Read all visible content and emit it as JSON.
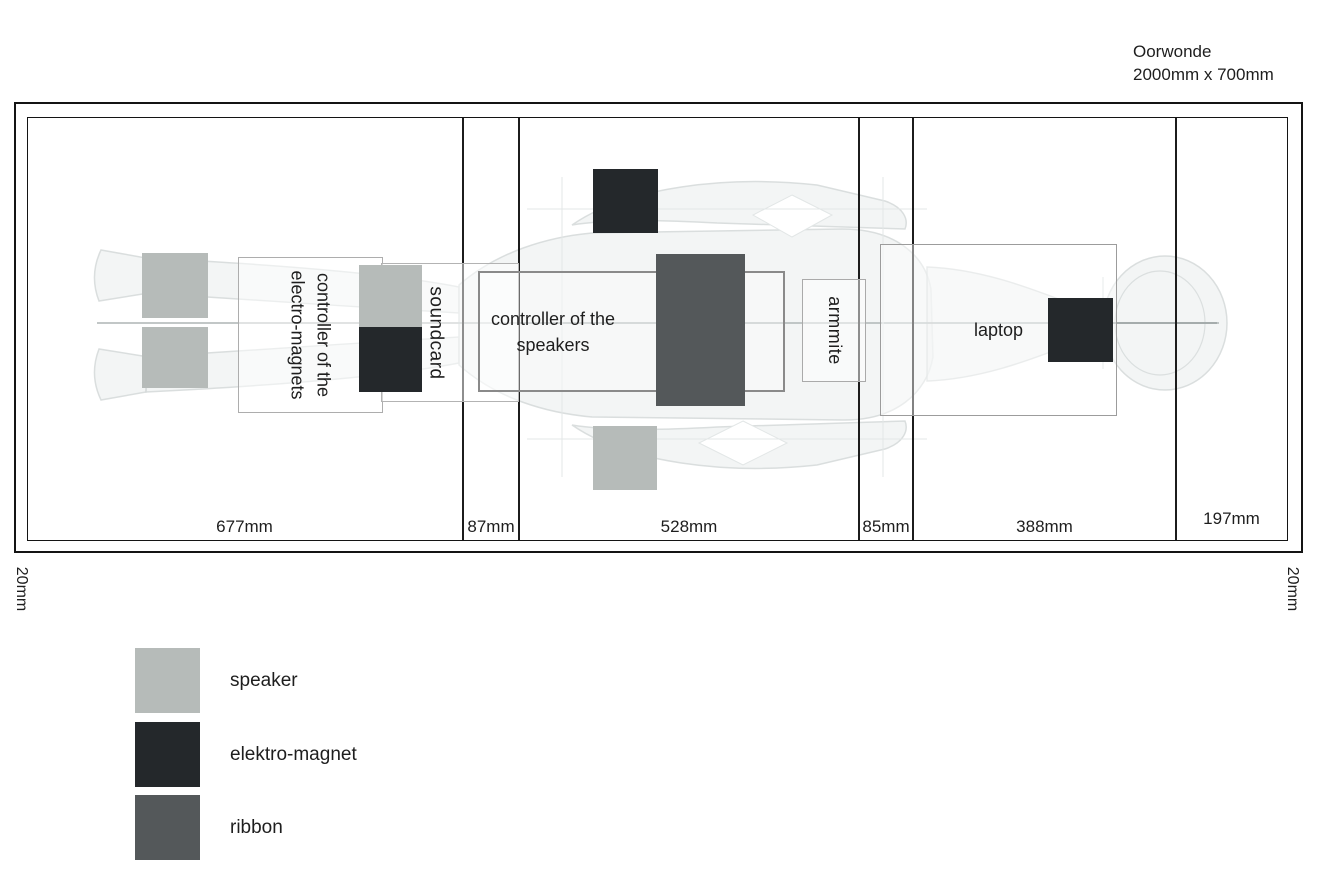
{
  "title": {
    "line1": "Oorwonde",
    "line2": "2000mm x 700mm"
  },
  "frame": {
    "margin_left": "20mm",
    "margin_right": "20mm"
  },
  "sections": [
    {
      "label": "677mm"
    },
    {
      "label": "87mm"
    },
    {
      "label": "528mm"
    },
    {
      "label": "85mm"
    },
    {
      "label": "388mm"
    },
    {
      "label": "197mm"
    }
  ],
  "components": {
    "controller_magnets": {
      "line1": "controller of the",
      "line2": "electro-magnets"
    },
    "soundcard": {
      "label": "soundcard"
    },
    "controller_speakers": {
      "line1": "controller of the",
      "line2": "speakers"
    },
    "armmite": {
      "label": "armmite"
    },
    "laptop": {
      "label": "laptop"
    }
  },
  "legend": [
    {
      "label": "speaker",
      "color": "#b6bbb9"
    },
    {
      "label": "elektro-magnet",
      "color": "#24282b"
    },
    {
      "label": "ribbon",
      "color": "#54585a"
    }
  ],
  "colors": {
    "speaker": "#b6bbb9",
    "magnet": "#24282b",
    "ribbon": "#54585a"
  }
}
